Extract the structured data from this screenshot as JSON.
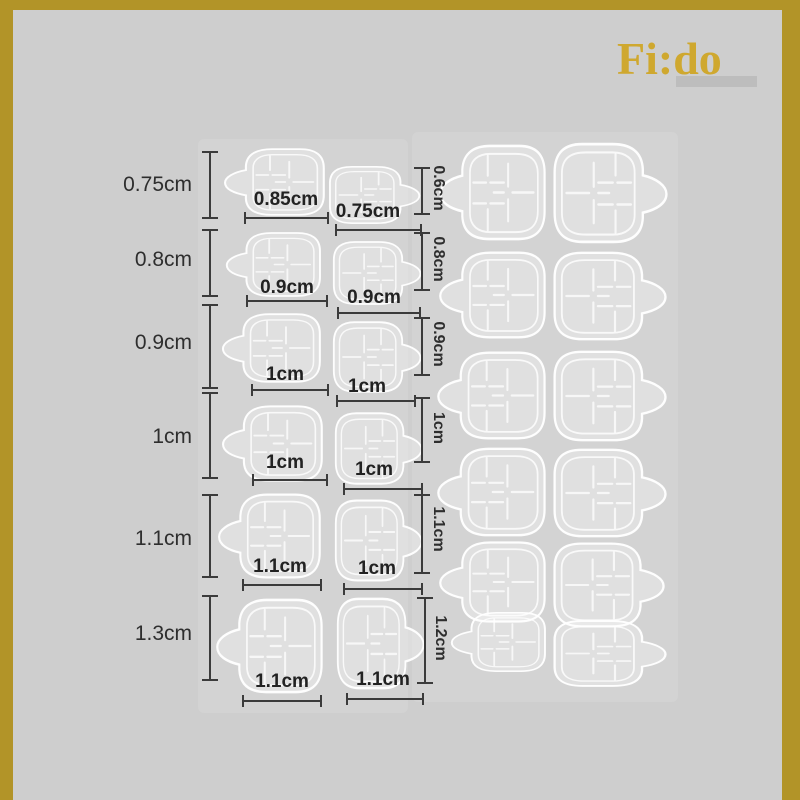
{
  "brand": {
    "logo_text": "Fi:do"
  },
  "size_chart": {
    "unit": "cm",
    "description_semantics": "nail-adhesive-tab-size-diagram",
    "left_sheet": {
      "rows": [
        {
          "height_label": "0.75cm",
          "nail1_width_label": "0.85cm",
          "nail2_width_label": "0.75cm"
        },
        {
          "height_label": "0.8cm",
          "nail1_width_label": "0.9cm",
          "nail2_width_label": "0.9cm"
        },
        {
          "height_label": "0.9cm",
          "nail1_width_label": "1cm",
          "nail2_width_label": "1cm"
        },
        {
          "height_label": "1cm",
          "nail1_width_label": "1cm",
          "nail2_width_label": "1cm"
        },
        {
          "height_label": "1.1cm",
          "nail1_width_label": "1.1cm",
          "nail2_width_label": "1cm"
        },
        {
          "height_label": "1.3cm",
          "nail1_width_label": "1.1cm",
          "nail2_width_label": "1.1cm"
        }
      ]
    },
    "right_sheet": {
      "rows": [
        {
          "height_label": "0.6cm"
        },
        {
          "height_label": "0.8cm"
        },
        {
          "height_label": "0.9cm"
        },
        {
          "height_label": "1cm"
        },
        {
          "height_label": "1.1cm"
        },
        {
          "height_label": "1.2cm"
        }
      ]
    }
  },
  "colors": {
    "background": "#CECECE",
    "frame_gold": "#B29428",
    "logo_gold": "#CFA82F",
    "annotation_text": "#2B2B2B",
    "line_color": "#3B3B3B",
    "nail_outline": "#FFFFFF"
  }
}
